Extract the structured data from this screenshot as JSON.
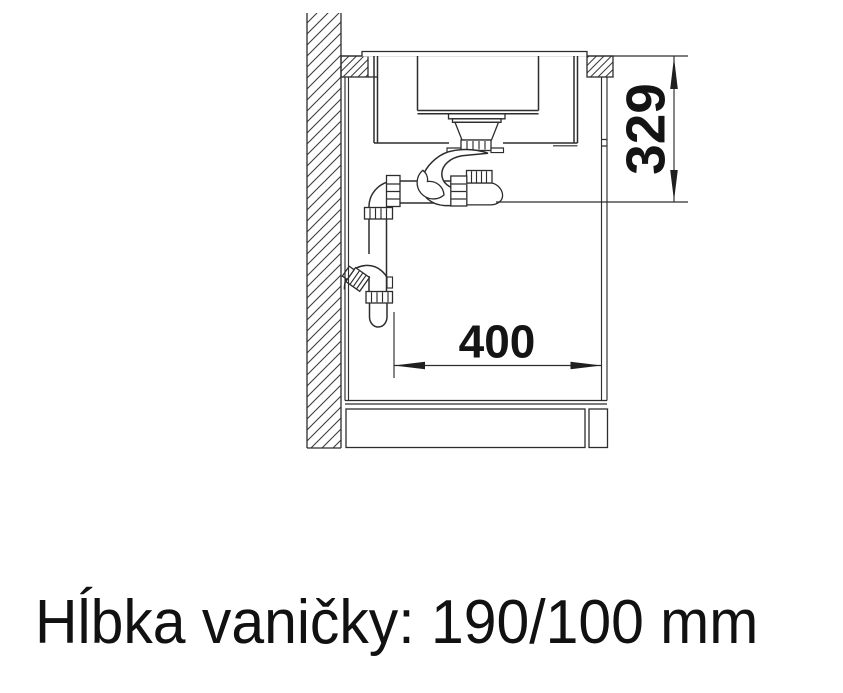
{
  "diagram": {
    "type": "technical-drawing",
    "subject": "sink-cabinet-cross-section-with-siphon",
    "caption": "Hĺbka vaničky: 190/100 mm",
    "dimensions": {
      "height": {
        "label": "329"
      },
      "width": {
        "label": "400"
      }
    },
    "colors": {
      "line": "#2d2d2d",
      "hatch": "#3d3d3d",
      "text": "#141414",
      "background": "#ffffff"
    }
  }
}
